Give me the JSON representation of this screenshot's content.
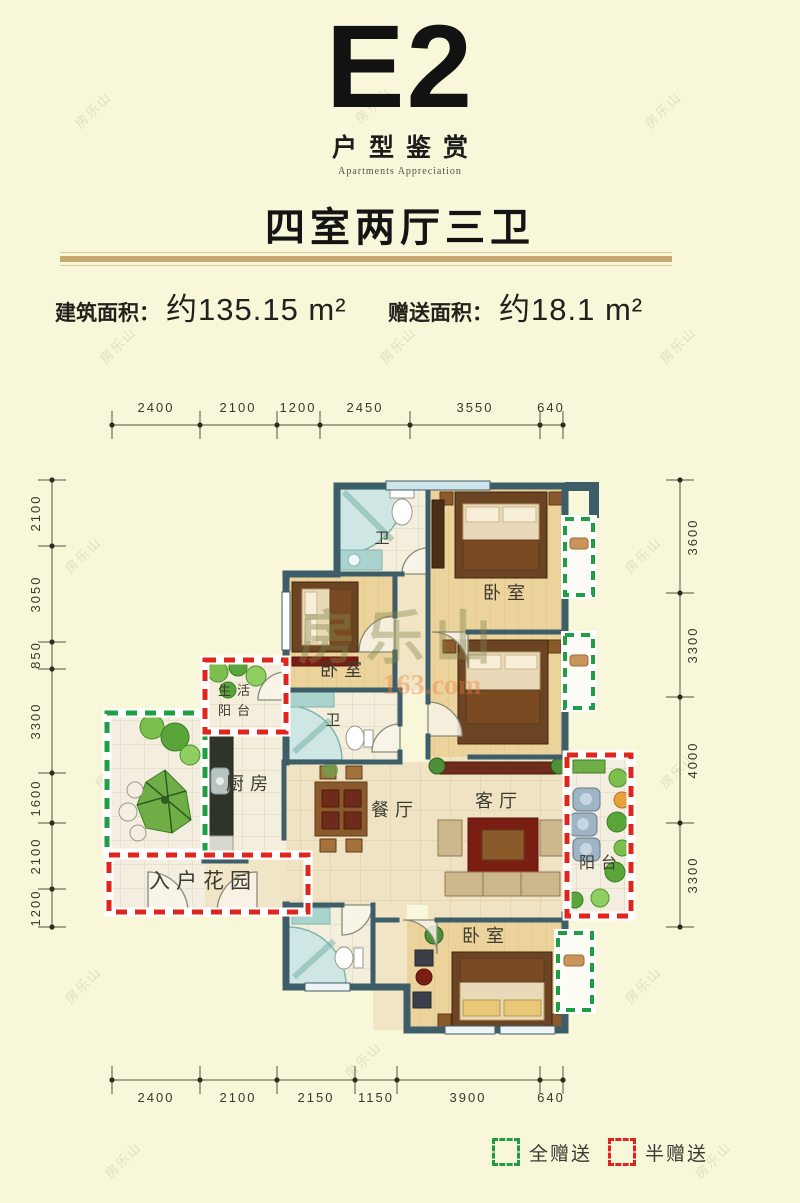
{
  "page": {
    "bg": "#f9f7da",
    "watermark": "房乐山"
  },
  "header": {
    "title": "E2",
    "subtitle": "户型鉴赏",
    "subtitle_en": "Apartments Appreciation",
    "layout": "四室两厅三卫"
  },
  "areas": {
    "built_label": "建筑面积：",
    "built_value": "约135.15 m²",
    "gift_label": "赠送面积：",
    "gift_value": "约18.1 m²"
  },
  "plan": {
    "wall_color": "#3d5d68",
    "dimensions": {
      "top": [
        "2400",
        "2100",
        "1200",
        "2450",
        "3550",
        "640"
      ],
      "bottom": [
        "2400",
        "2100",
        "2150",
        "1150",
        "3900",
        "640"
      ],
      "left": [
        "2100",
        "3050",
        "850",
        "3300",
        "1600",
        "2100",
        "1200"
      ],
      "right": [
        "3600",
        "3300",
        "4000",
        "3300"
      ]
    },
    "rooms": {
      "bath1": "卫",
      "bath2": "卫",
      "bedroom1": "卧室",
      "bedroom2": "卧室",
      "bedroom4": "卧室",
      "kitchen": "厨房",
      "dining": "餐厅",
      "living": "客厅",
      "balcony": "阳台",
      "service_l1": "生活",
      "service_l2": "阳台",
      "entry_garden": "入户花园"
    },
    "watermark_center": "房乐山",
    "watermark_site": "163.com"
  },
  "legend": {
    "full_gift": "全赠送",
    "half_gift": "半赠送",
    "green": "#1f9e43",
    "red": "#e0251c"
  }
}
